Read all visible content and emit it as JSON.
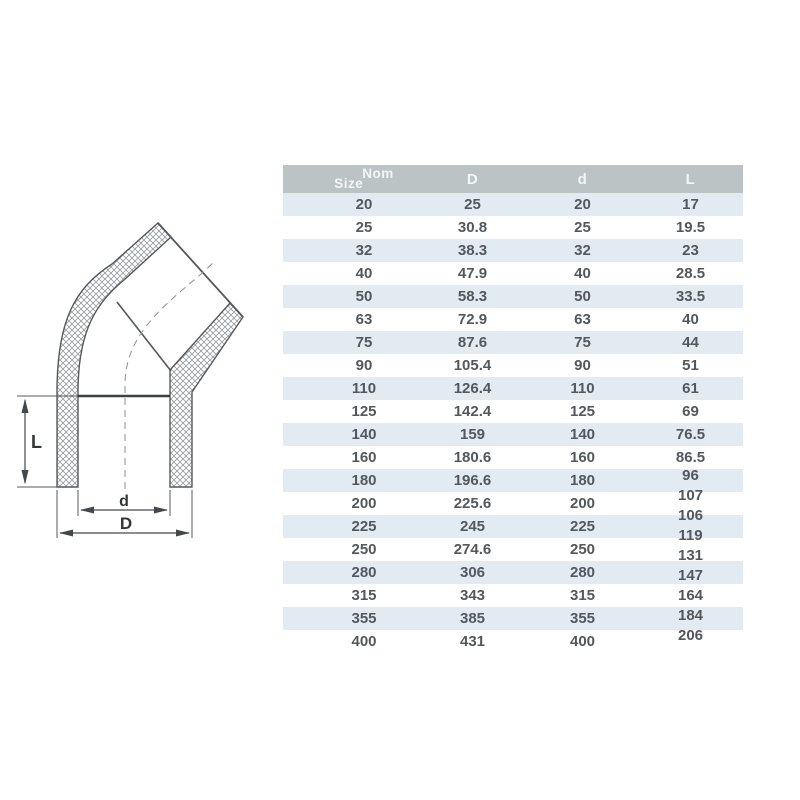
{
  "diagram": {
    "title": "45-degree elbow cross-section drawing",
    "labels": {
      "L": "L",
      "d": "d",
      "D": "D"
    }
  },
  "table": {
    "header": {
      "size": "Size",
      "nom": "Nom",
      "D": "D",
      "d": "d",
      "L": "L"
    },
    "rows": [
      {
        "size": "20",
        "D": "25",
        "d": "20",
        "L": "17"
      },
      {
        "size": "25",
        "D": "30.8",
        "d": "25",
        "L": "19.5"
      },
      {
        "size": "32",
        "D": "38.3",
        "d": "32",
        "L": "23"
      },
      {
        "size": "40",
        "D": "47.9",
        "d": "40",
        "L": "28.5"
      },
      {
        "size": "50",
        "D": "58.3",
        "d": "50",
        "L": "33.5"
      },
      {
        "size": "63",
        "D": "72.9",
        "d": "63",
        "L": "40"
      },
      {
        "size": "75",
        "D": "87.6",
        "d": "75",
        "L": "44"
      },
      {
        "size": "90",
        "D": "105.4",
        "d": "90",
        "L": "51"
      },
      {
        "size": "110",
        "D": "126.4",
        "d": "110",
        "L": "61"
      },
      {
        "size": "125",
        "D": "142.4",
        "d": "125",
        "L": "69"
      },
      {
        "size": "140",
        "D": "159",
        "d": "140",
        "L": "76.5"
      },
      {
        "size": "160",
        "D": "180.6",
        "d": "160",
        "L": "86.5"
      },
      {
        "size": "180",
        "D": "196.6",
        "d": "180",
        "L": ""
      },
      {
        "size": "200",
        "D": "225.6",
        "d": "200",
        "L": ""
      },
      {
        "size": "225",
        "D": "245",
        "d": "225",
        "L": ""
      },
      {
        "size": "250",
        "D": "274.6",
        "d": "250",
        "L": ""
      },
      {
        "size": "280",
        "D": "306",
        "d": "280",
        "L": ""
      },
      {
        "size": "315",
        "D": "343",
        "d": "315",
        "L": ""
      },
      {
        "size": "355",
        "D": "385",
        "d": "355",
        "L": ""
      },
      {
        "size": "400",
        "D": "431",
        "d": "400",
        "L": ""
      }
    ],
    "l_column_offset_values": [
      "96",
      "107",
      "106",
      "119",
      "131",
      "147",
      "164",
      "184",
      "206"
    ]
  },
  "colors": {
    "header_bg": "#bcc3c5",
    "header_text": "#f3f6f6",
    "row_stripe": "#e1ebf1",
    "row_text": "#53585c",
    "line_dark": "#4a4e52",
    "hatch": "#939a9e",
    "centerline": "#8b8f93"
  }
}
